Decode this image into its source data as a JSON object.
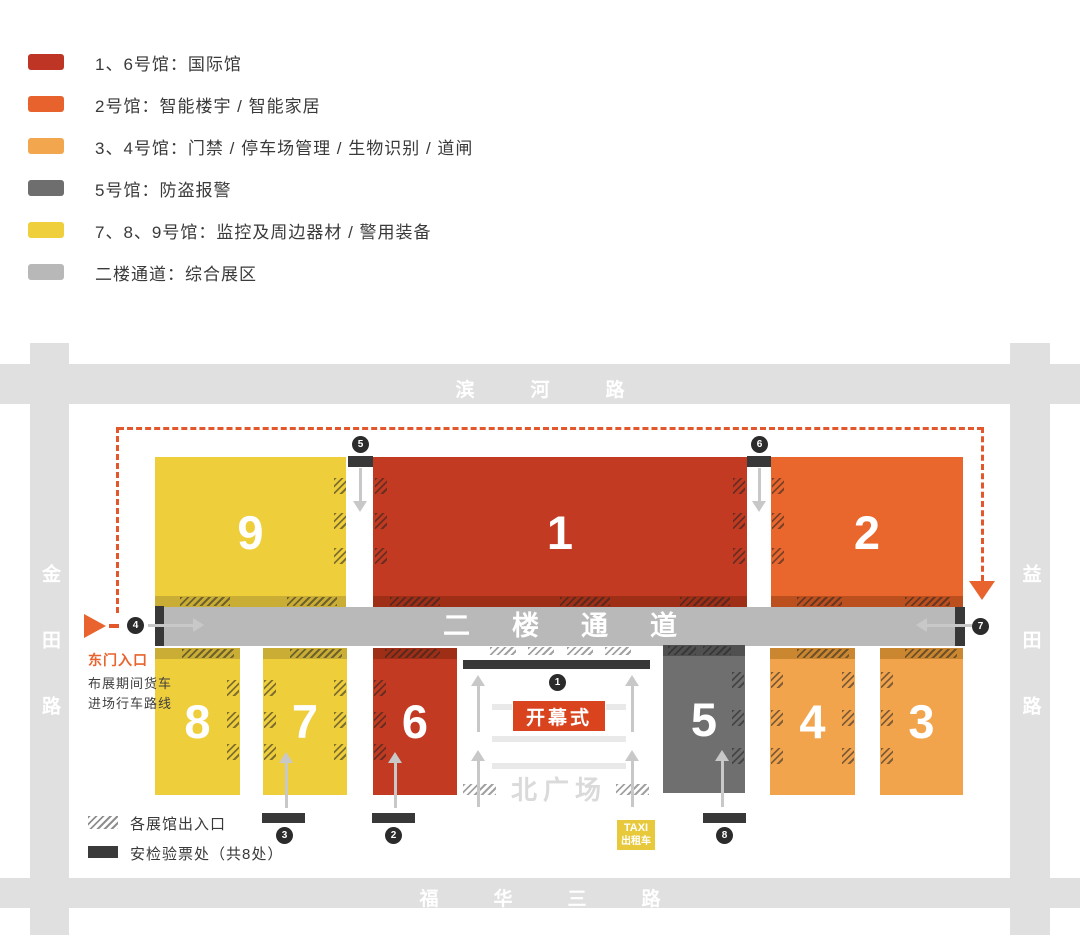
{
  "legend": {
    "items": [
      {
        "color": "#be3425",
        "label": "1、6号馆：国际馆"
      },
      {
        "color": "#e8622d",
        "label": "2号馆：智能楼宇 / 智能家居"
      },
      {
        "color": "#f2a74f",
        "label": "3、4号馆：门禁 / 停车场管理 / 生物识别 / 道闸"
      },
      {
        "color": "#6e6e6e",
        "label": "5号馆：防盗报警"
      },
      {
        "color": "#efd03c",
        "label": "7、8、9号馆：监控及周边器材 / 警用装备"
      },
      {
        "color": "#b8b8b8",
        "label": "二楼通道：综合展区"
      }
    ]
  },
  "roads": {
    "north": "滨河路",
    "south": "福华三路",
    "west": "金田路",
    "east": "益田路"
  },
  "map": {
    "corridor_label": "二楼通道",
    "halls": {
      "h1": "1",
      "h2": "2",
      "h3": "3",
      "h4": "4",
      "h5": "5",
      "h6": "6",
      "h7": "7",
      "h8": "8",
      "h9": "9"
    },
    "markers": {
      "m1": "1",
      "m2": "2",
      "m3": "3",
      "m4": "4",
      "m5": "5",
      "m6": "6",
      "m7": "7",
      "m8": "8"
    },
    "ceremony_label": "开幕式",
    "plaza_label": "北广场",
    "taxi": {
      "line1": "TAXI",
      "line2": "出租车"
    },
    "east_gate_label": "东门入口",
    "truck_route_note": [
      "布展期间货车",
      "进场行车路线"
    ]
  },
  "map_legend": {
    "entrance_label": "各展馆出入口",
    "security_label": "安检验票处（共8处）"
  },
  "colors": {
    "hall_red": "#c23a21",
    "hall_orange": "#e9662c",
    "hall_light_orange": "#f2a44c",
    "hall_gray": "#6f6f6f",
    "hall_yellow": "#efce3c",
    "corridor_gray": "#b9b9b9",
    "road_gray": "#e0e0e0",
    "route_orange": "#e2572b",
    "checkpoint_dark": "#383838",
    "ceremony_red": "#d9441f",
    "taxi_yellow": "#e7c93b"
  }
}
